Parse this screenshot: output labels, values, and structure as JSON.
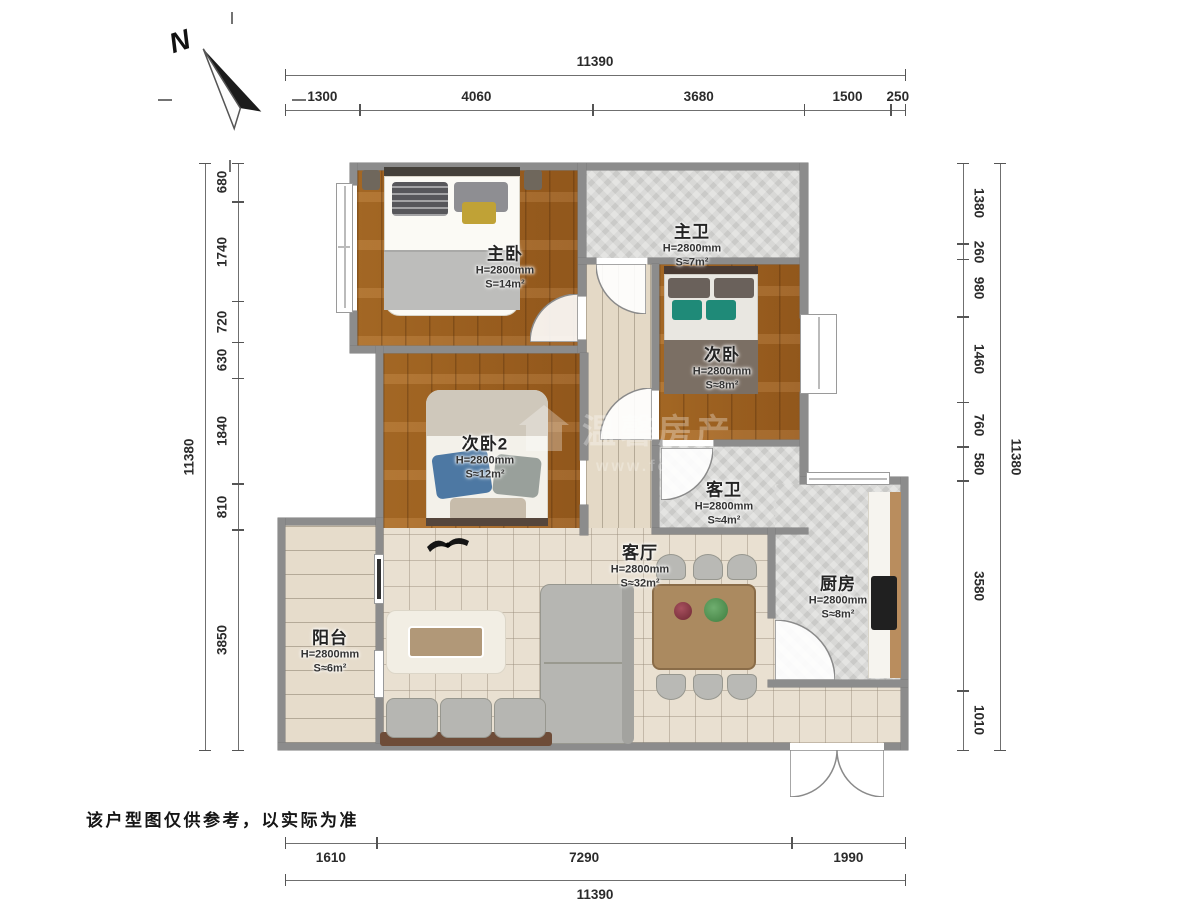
{
  "page": {
    "north_label": "N",
    "disclaimer": "该户型图仅供参考，以实际为准"
  },
  "watermark": {
    "brand": "温馨房产",
    "url": "www.fc"
  },
  "colors": {
    "wall": "#8c8c8c",
    "wood_floor": "#a4661f",
    "tile_gray": "#d8d8d6",
    "tile_beige": "#e9e0d1",
    "teal_pillow": "#1f8a78"
  },
  "rooms": [
    {
      "id": "master-bedroom",
      "name": "主卧",
      "height": "H=2800mm",
      "area": "S=14m²"
    },
    {
      "id": "master-bath",
      "name": "主卫",
      "height": "H=2800mm",
      "area": "S≈7m²"
    },
    {
      "id": "bedroom-2",
      "name": "次卧",
      "height": "H=2800mm",
      "area": "S≈8m²"
    },
    {
      "id": "bedroom-3",
      "name": "次卧2",
      "height": "H=2800mm",
      "area": "S≈12m²"
    },
    {
      "id": "guest-bath",
      "name": "客卫",
      "height": "H=2800mm",
      "area": "S≈4m²"
    },
    {
      "id": "living-room",
      "name": "客厅",
      "height": "H=2800mm",
      "area": "S≈32m²"
    },
    {
      "id": "kitchen",
      "name": "厨房",
      "height": "H=2800mm",
      "area": "S≈8m²"
    },
    {
      "id": "balcony",
      "name": "阳台",
      "height": "H=2800mm",
      "area": "S≈6m²"
    }
  ],
  "dimensions": {
    "top": {
      "total": "11390",
      "segments": [
        "1300",
        "4060",
        "3680",
        "1500",
        "250"
      ]
    },
    "bottom": {
      "total": "11390",
      "segments": [
        "1610",
        "7290",
        "1990"
      ]
    },
    "left": {
      "total": "11380",
      "segments": [
        "680",
        "1740",
        "720",
        "630",
        "1840",
        "810",
        "3850"
      ]
    },
    "right": {
      "total": "11380",
      "segments": [
        "1380",
        "260",
        "980",
        "1460",
        "760",
        "580",
        "3580",
        "1010"
      ]
    }
  }
}
